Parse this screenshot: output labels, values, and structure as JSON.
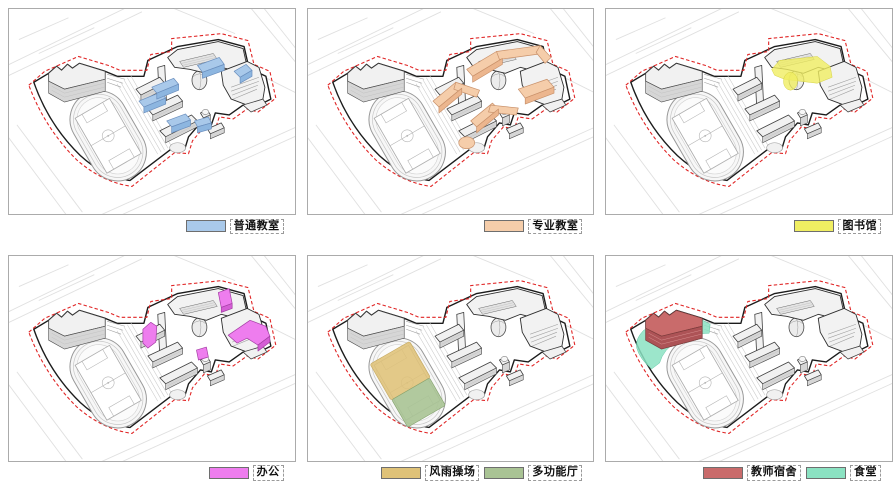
{
  "diagram": {
    "type": "architecture-function-analysis",
    "subject": "school campus axonometric program diagrams",
    "panel_count": 6
  },
  "palette": {
    "ordinary_top": "#a9c9ea",
    "ordinary_side": "#8db6e0",
    "special_top": "#f5cdaa",
    "special_side": "#ecb68e",
    "library": "#f0ee62",
    "office_top": "#ee7dee",
    "office_side": "#d55ed5",
    "playground": "#dfc278",
    "hall": "#a9c394",
    "dorm_top": "#c96b6b",
    "dorm_side": "#ad5356",
    "canteen": "#8be2c2",
    "site_outline": "#1c1c1c",
    "setback_line": "#e02525"
  },
  "panels": [
    {
      "id": "ordinary-classrooms",
      "legend": [
        {
          "label": "普通教室",
          "color": "#a9c9ea"
        }
      ]
    },
    {
      "id": "specialized-classrooms",
      "legend": [
        {
          "label": "专业教室",
          "color": "#f5cdaa"
        }
      ]
    },
    {
      "id": "library",
      "legend": [
        {
          "label": "图书馆",
          "color": "#f0ee62"
        }
      ]
    },
    {
      "id": "office",
      "legend": [
        {
          "label": "办公",
          "color": "#ee7dee"
        }
      ]
    },
    {
      "id": "sports-hall",
      "legend": [
        {
          "label": "风雨操场",
          "color": "#dfc278"
        },
        {
          "label": "多功能厅",
          "color": "#a9c394"
        }
      ]
    },
    {
      "id": "dorm-canteen",
      "legend": [
        {
          "label": "教师宿舍",
          "color": "#c96b6b"
        },
        {
          "label": "食堂",
          "color": "#8be2c2"
        }
      ]
    }
  ]
}
